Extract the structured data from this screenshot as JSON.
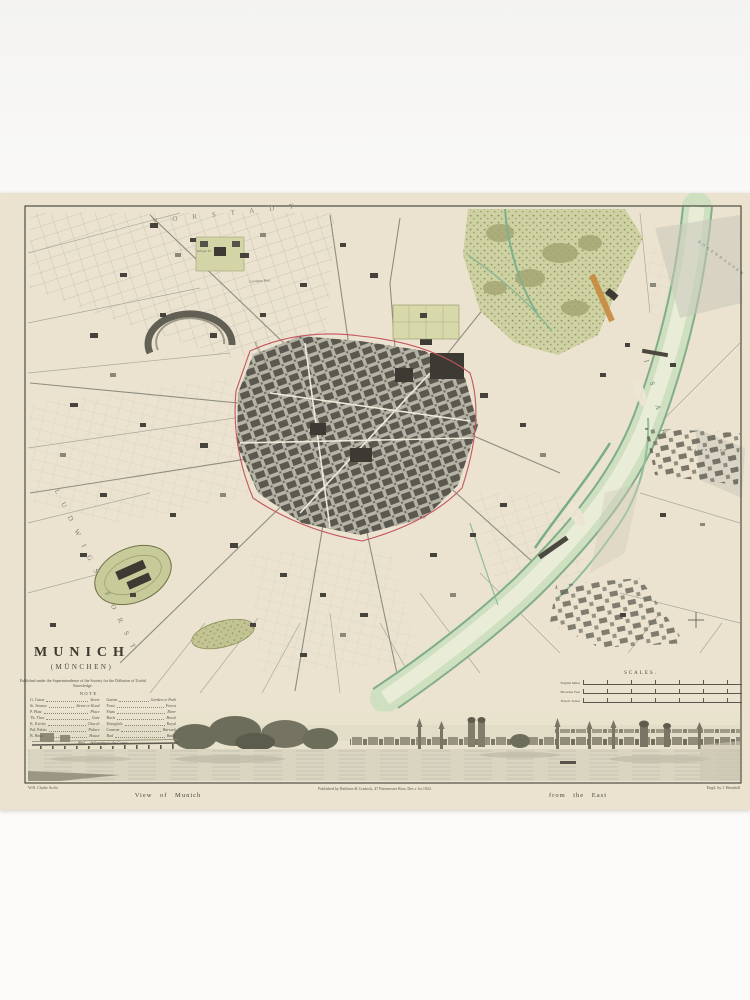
{
  "map": {
    "title": "MUNICH",
    "subtitle": "(MÜNCHEN)",
    "imprint": "Published under the Superintendence of the Society for the Diffusion of Useful Knowledge.",
    "note": {
      "heading": "NOTE.",
      "left_rows": [
        [
          "G. Gasse",
          "Street"
        ],
        [
          "St. Strasse",
          "Street or Road"
        ],
        [
          "P. Platz",
          "Place"
        ],
        [
          "Th. Thor",
          "Gate"
        ],
        [
          "K. Kirche",
          "Church"
        ],
        [
          "Pal. Palais",
          "Palace"
        ],
        [
          "B. Haus",
          "House"
        ]
      ],
      "right_rows": [
        [
          "Garten",
          "Garden or Park"
        ],
        [
          "Forst",
          "Forest"
        ],
        [
          "Fluss",
          "River"
        ],
        [
          "Bach",
          "Brook"
        ],
        [
          "Königlich",
          "Royal"
        ],
        [
          "Caserne",
          "Barrack"
        ],
        [
          "Bad",
          "Baths"
        ]
      ],
      "footer": "Red .... belonging to the Court."
    },
    "scales": {
      "heading": "SCALES.",
      "rows": [
        {
          "label": "English Miles"
        },
        {
          "label": "Bavarian Feet"
        },
        {
          "label": "French Toises"
        }
      ]
    },
    "region_labels": {
      "vorstadt": "VORSTADT",
      "forest": "LUDWIGS FORST",
      "river": "ISAR",
      "haidhausen": "HAIDHAUSEN",
      "bogenhausen": "BOGENHAUSEN",
      "koenigsplatz": "Königs Pl.",
      "carolinenplatz": "Carolinen Platz",
      "maximiliansplatz": "Maximilians Platz"
    },
    "panorama": {
      "artist": "W.B. Clarke Archt.",
      "publisher": "Published by Baldwin & Cradock, 47 Paternoster Row, Dec.r 1st 1832.",
      "view_title_left": "View of Munich",
      "view_title_right": "from the East",
      "engraver": "Engd. by J. Henshall"
    }
  },
  "colors": {
    "paper": "#ebe3cf",
    "river_green": "#8fbf98",
    "park_olive": "#ced1a2",
    "wall_red": "#c4545e",
    "building_dark": "#45433c",
    "orange_accent": "#c8893f"
  }
}
